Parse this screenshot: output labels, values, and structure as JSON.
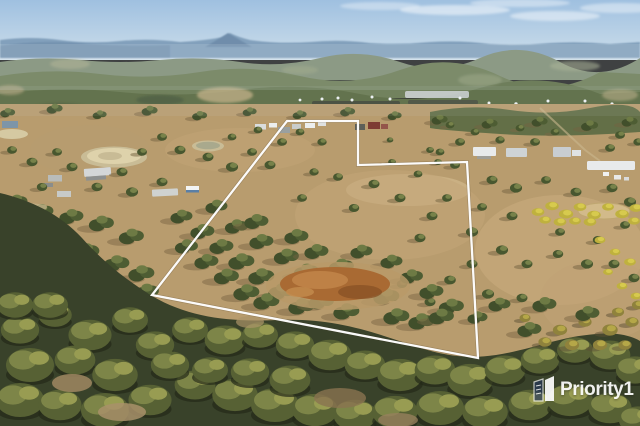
{
  "image": {
    "kind": "aerial-drone-photo",
    "subject": "Rural acreage with white lot-boundary outline drawn over dry paddocks and bushland",
    "width_px": 640,
    "height_px": 426
  },
  "watermark": {
    "brand": "Priority1",
    "text_color": "#ffffff"
  },
  "boundary": {
    "points": "287,121 358,121 358,165 467,162 478,358 152,295",
    "stroke": "#ffffff",
    "stroke_width": 2.3
  },
  "palette": {
    "sky_top": "#9fc0e0",
    "sky_horizon": "#d5e3ed",
    "distant_hills": "#7d99b5",
    "distant_scrub": "#6a7a52",
    "tree_olive": "#4d5b36",
    "paddock_tan": "#b89c6e",
    "paddock_light": "#cdb487",
    "bush_dark": "#39422a",
    "bush_highlight": "#989c52",
    "gorse_yellow": "#c9bb45",
    "dirt_orange": "#a96a33",
    "dam_sand": "#ded2ab",
    "roof_white": "#e8eaeb"
  }
}
